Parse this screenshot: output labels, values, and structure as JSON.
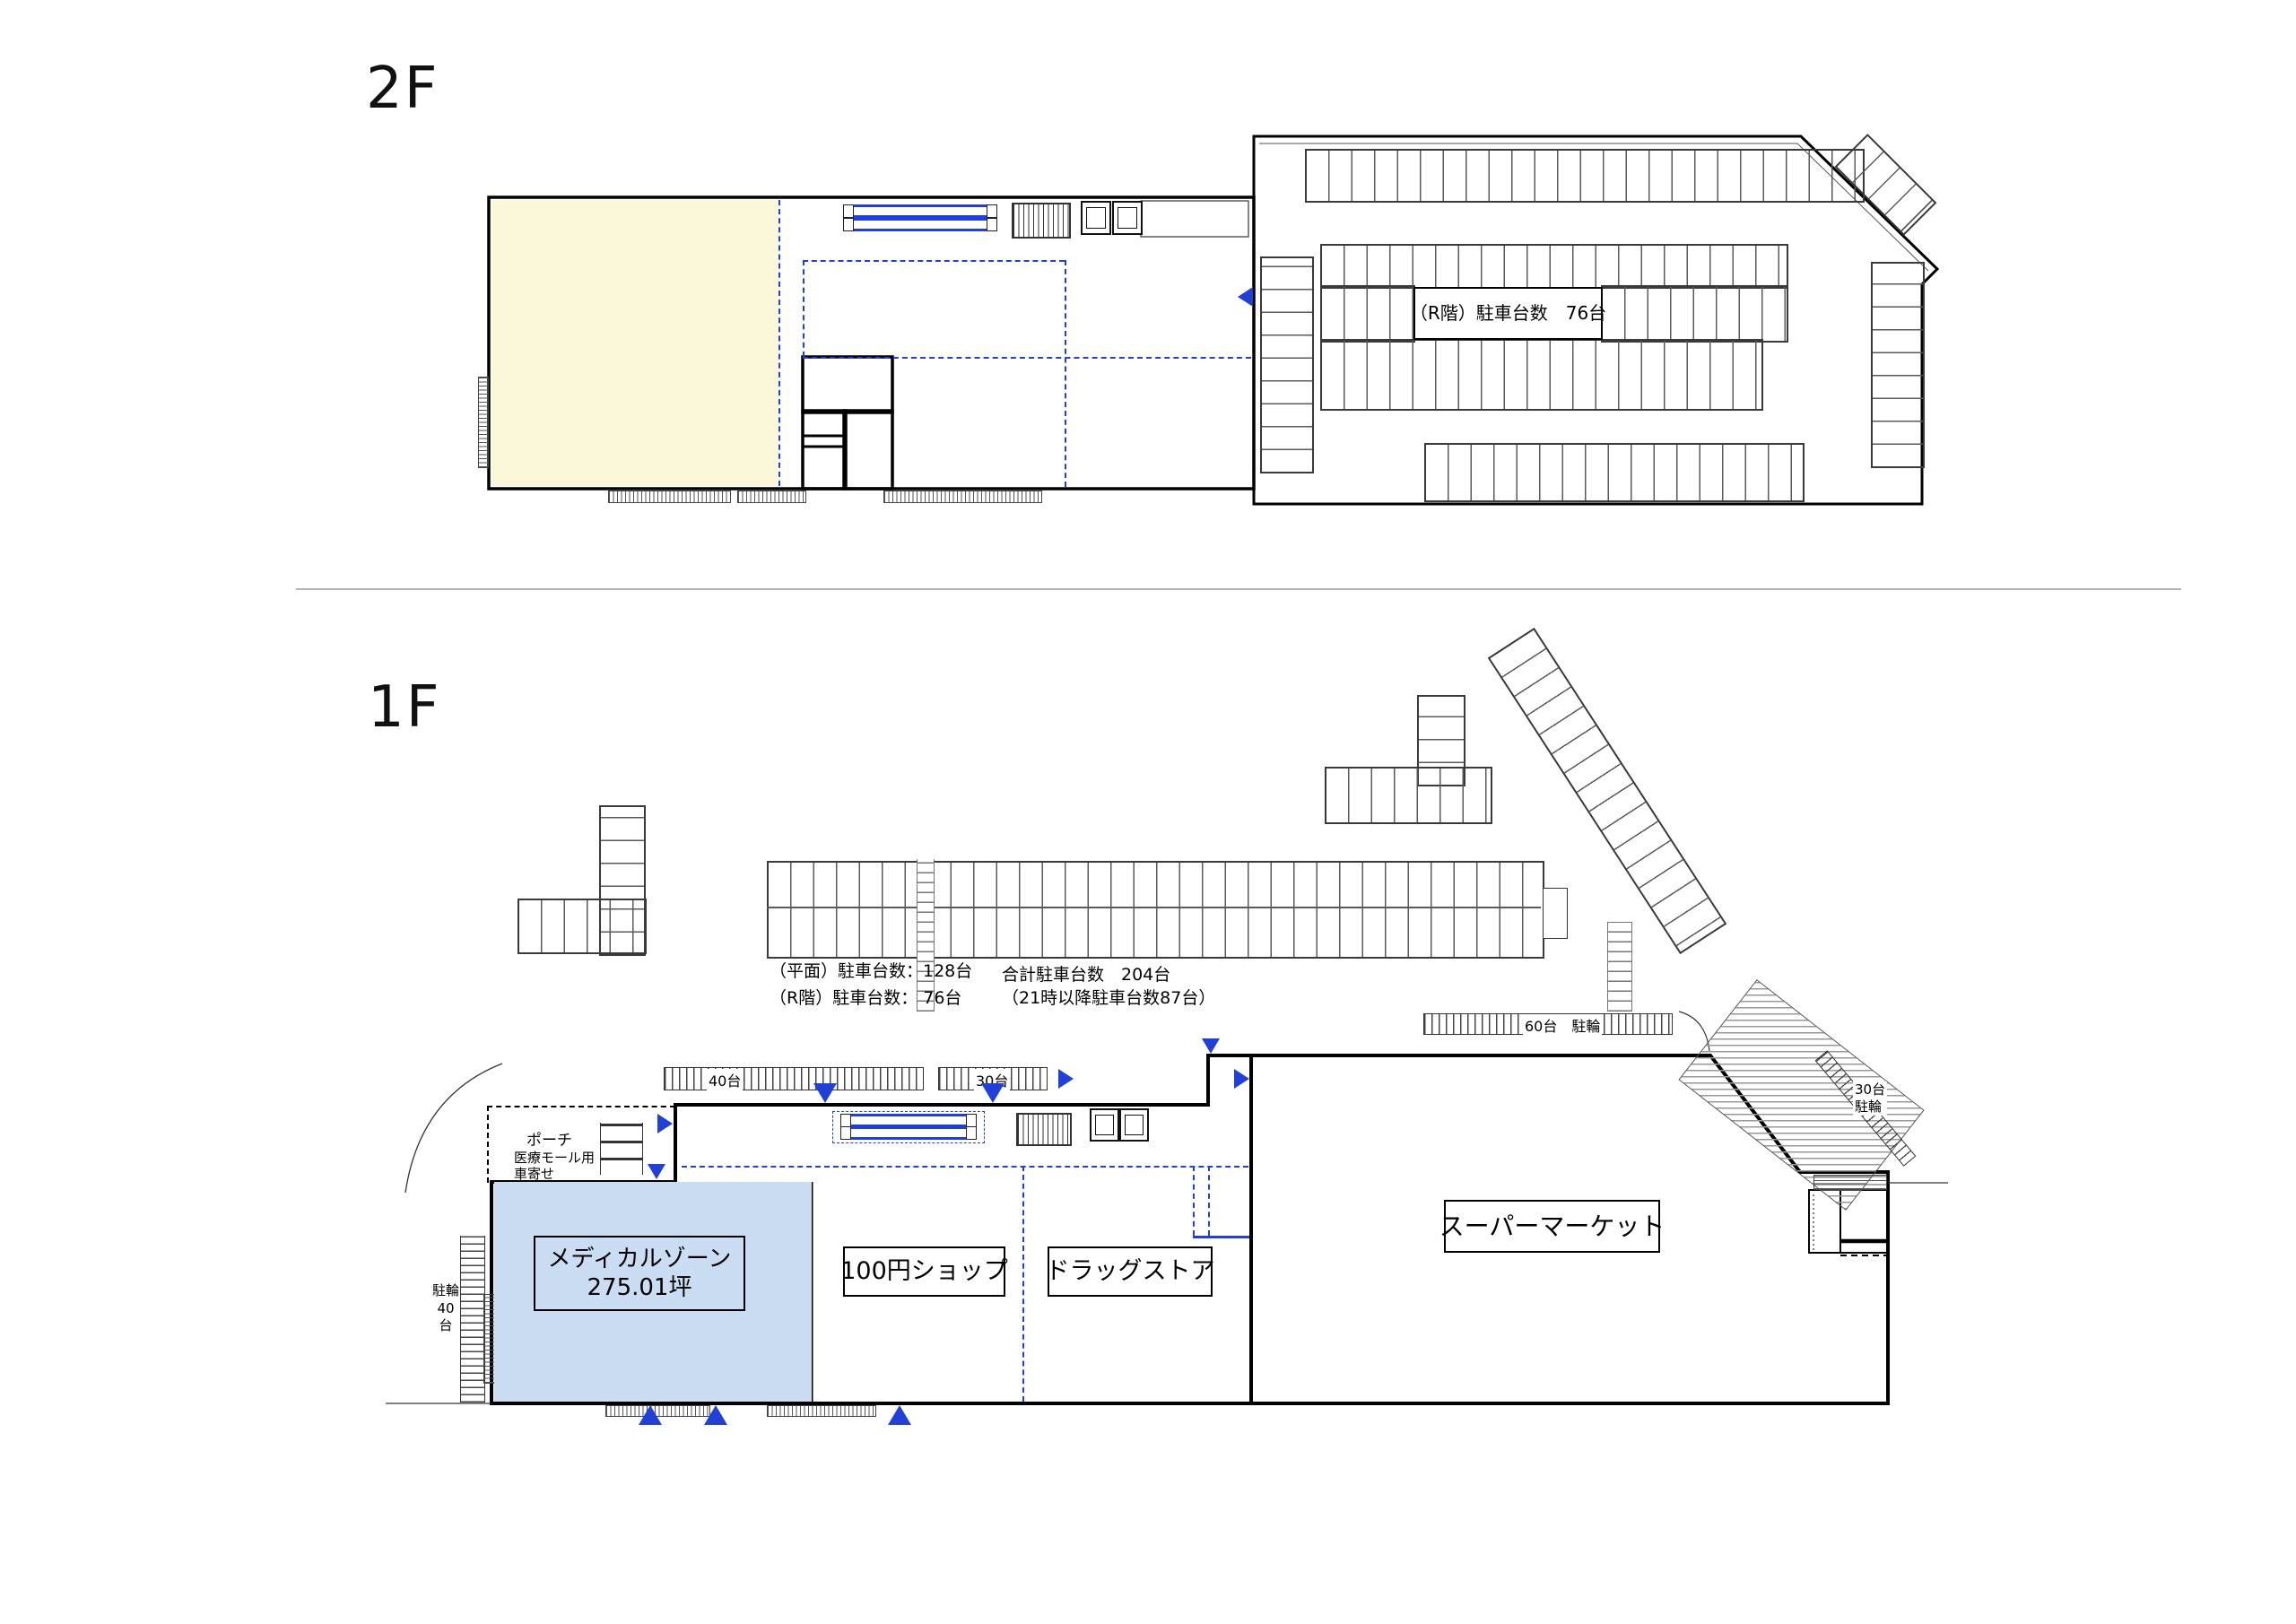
{
  "colors": {
    "accent_blue": "#2140D8",
    "zone_yellow": "#FBF8D9",
    "zone_blue": "#CBDDF2"
  },
  "floor2": {
    "label": "2F",
    "rooftop_note": "（R階）駐車台数　76台"
  },
  "floor1": {
    "label": "1F",
    "stats": {
      "flat": "（平面）駐車台数：128台",
      "roof": "（R階）駐車台数： 76台",
      "total": "合計駐車台数　204台",
      "night": "（21時以降駐車台数87台）"
    },
    "bike": {
      "left1": "駐輪",
      "left2": "40台",
      "mid40": "40台",
      "mid30": "30台",
      "row60": "60台　駐輪",
      "diag1": "30台",
      "diag2": "駐輪"
    },
    "porch": {
      "l1": "ポーチ",
      "l2": "医療モール用",
      "l3": "車寄せ"
    },
    "tenants": {
      "medical1": "メディカルゾーン",
      "medical2": "275.01坪",
      "shop100": "100円ショップ",
      "drug": "ドラッグストア",
      "market": "スーパーマーケット"
    }
  }
}
